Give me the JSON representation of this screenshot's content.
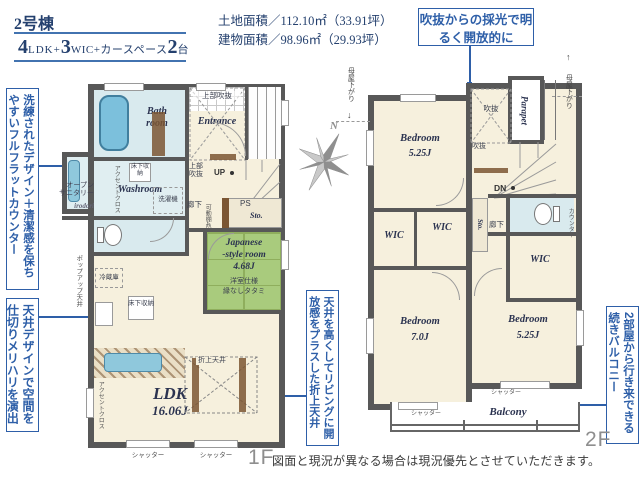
{
  "colors": {
    "accent": "#2e5fa8",
    "navy": "#24406e",
    "wall": "#585858",
    "tatami": "#a9cb7d",
    "water": "#d9eaee"
  },
  "header": {
    "building": "2号棟",
    "n1": "4",
    "t1": "LDK+",
    "n2": "3",
    "t2": "WIC+カースペース",
    "n3": "2",
    "t3": "台",
    "land": "土地面積／112.10㎡（33.91坪）",
    "bldg": "建物面積／98.96㎡（29.93坪）"
  },
  "callouts": {
    "skylight": "吹抜からの採光で明るく開放的に",
    "counter": "洗練されたデザイン＋清潔感を保ちやすいフルフラットカウンター",
    "ceiling": "天井デザインで空間を仕切りメリハリを演出",
    "coffered": "天井を高くしてリビングに開放感をプラスした折上天井",
    "balcony": "2部屋から行き来できる続きバルコニー"
  },
  "compass": {
    "n": "N"
  },
  "f1": {
    "bath_l1": "Bath",
    "bath_l2": "room",
    "washroom": "Washroom",
    "yukashita": "床下収納",
    "sentakuki": "洗濯機",
    "accent_cloth": "アクセントクロス",
    "joubu": "上部吹抜",
    "entrance": "Entrance",
    "up": "UP",
    "rouka": "廊下",
    "kadoudana": "可動棚4段",
    "ps": "PS",
    "sto": "Sto.",
    "jp1": "Japanese",
    "jp2": "-style room",
    "jp3": "4.68J",
    "jp4": "洋室仕様",
    "jp5": "縁なしタタミ",
    "reizouko": "冷蔵庫",
    "popup": "ポップアップ天井",
    "os1": "オープン",
    "os2": "サニタリー",
    "irodori": "irodori",
    "oriage": "折上天井",
    "ldk": "LDK",
    "ldk_size": "16.06J",
    "shutter": "シャッター",
    "floor": "1F"
  },
  "f2": {
    "bedroom": "Bedroom",
    "b1_size": "5.25J",
    "b2_size": "7.0J",
    "b3_size": "5.25J",
    "fukinuke": "吹抜",
    "parapet": "Parapet",
    "dn": "DN",
    "moya": "母屋下がり",
    "arrow_up": "↑",
    "arrow_down": "↓",
    "wic": "WIC",
    "sto": "Sto.",
    "rouka": "廊下",
    "counter": "カウンター",
    "balcony": "Balcony",
    "shutter": "シャッター",
    "floor": "2F"
  },
  "disclaimer": "図面と現況が異なる場合は現況優先とさせていただきます。"
}
